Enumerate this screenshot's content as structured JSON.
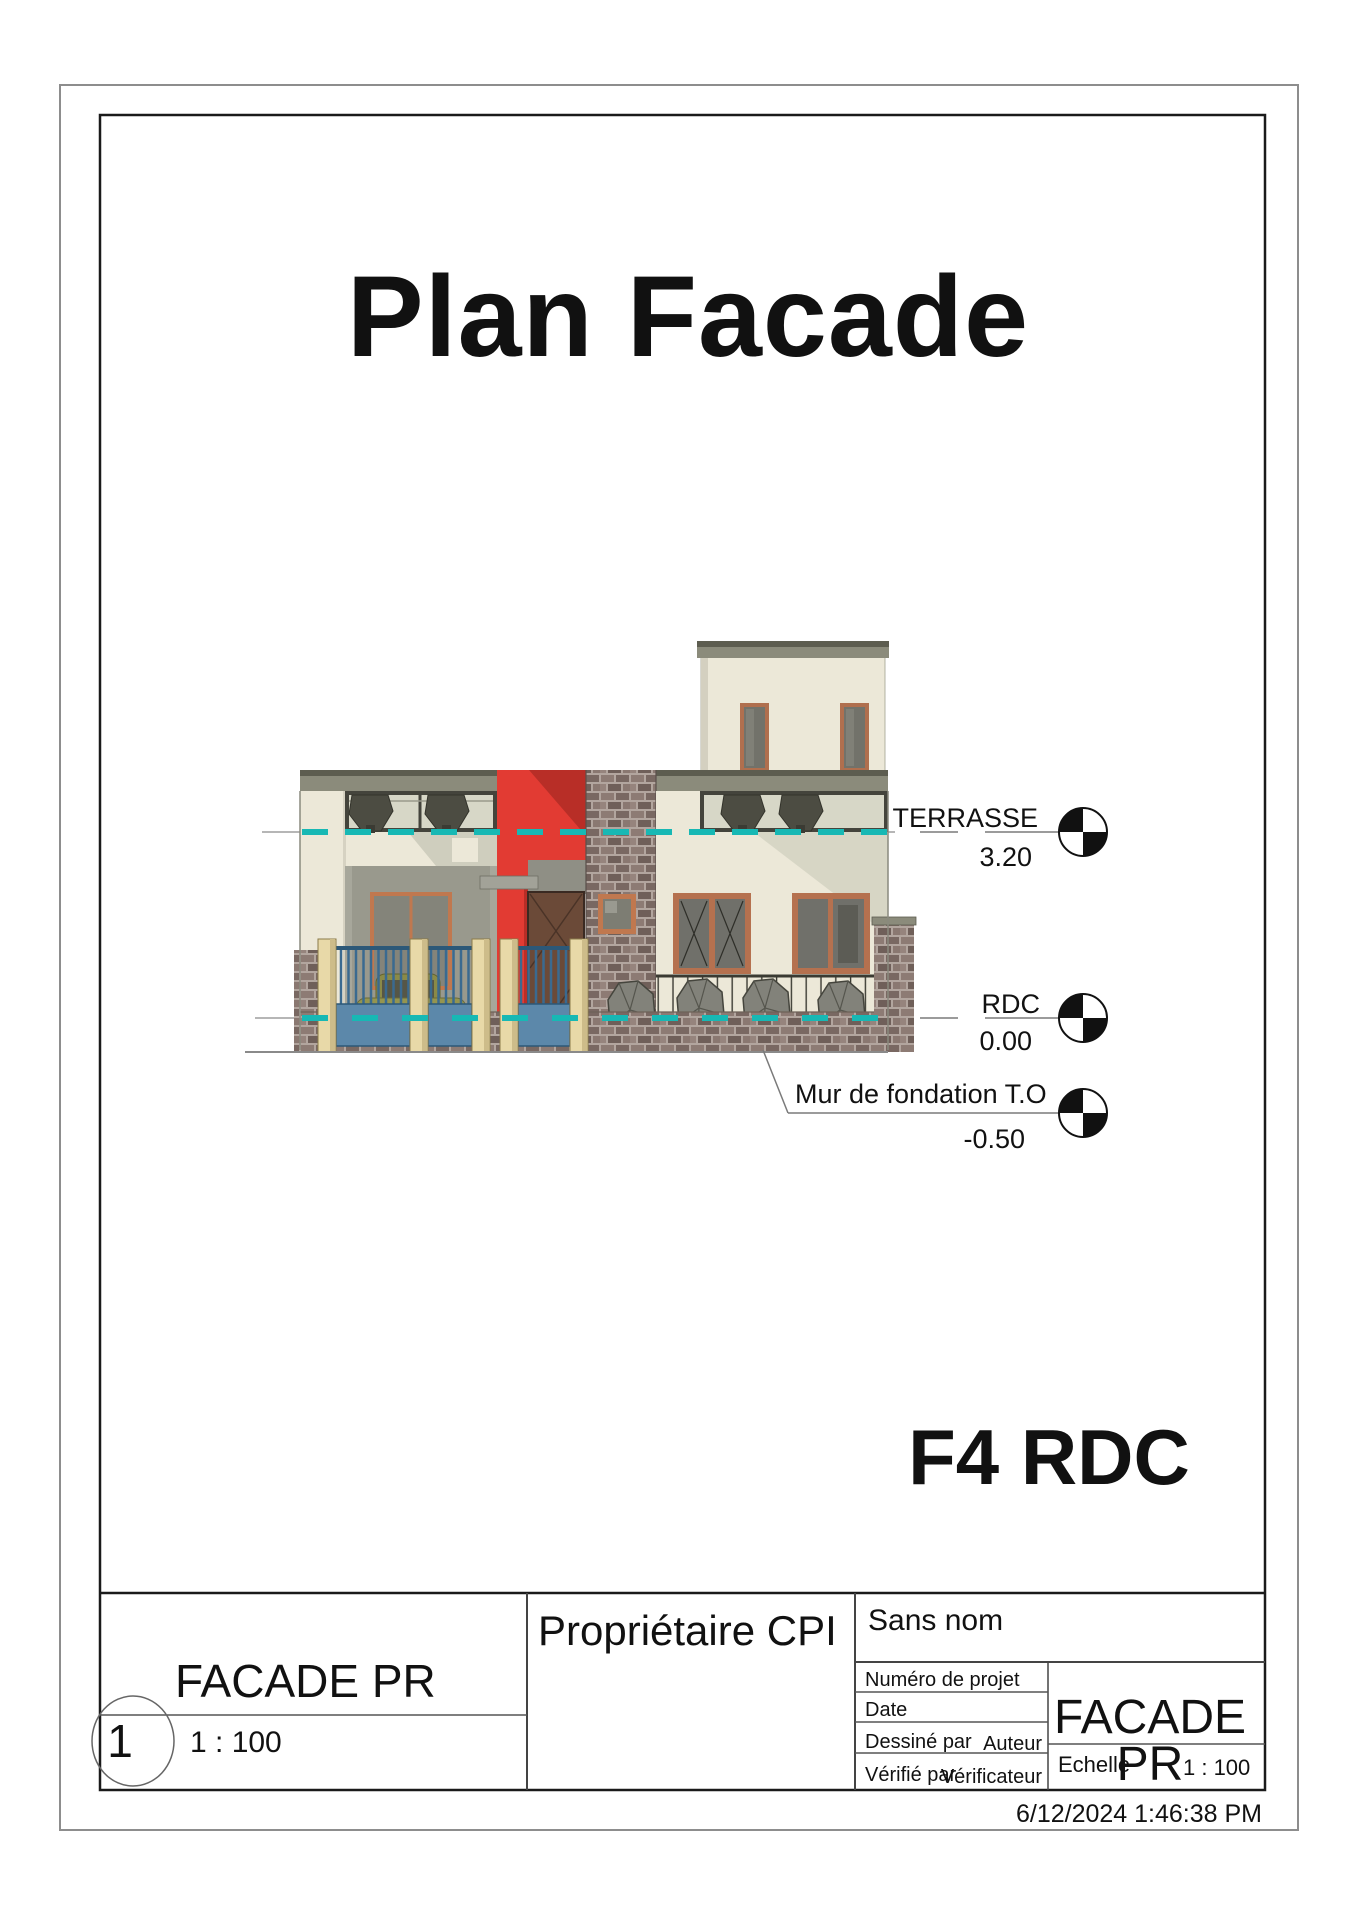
{
  "sheet": {
    "title": "Plan Facade",
    "drawing_label": "F4 RDC",
    "timestamp": "6/12/2024 1:46:38 PM"
  },
  "levels": [
    {
      "name": "TERRASSE",
      "elevation": "3.20",
      "icon": "level-datum-quadrant-circle"
    },
    {
      "name": "RDC",
      "elevation": "0.00",
      "icon": "level-datum-quadrant-circle"
    },
    {
      "name": "Mur de fondation T.O",
      "elevation": "-0.50",
      "icon": "level-datum-quadrant-circle"
    }
  ],
  "viewport": {
    "number": "1",
    "title": "FACADE PR",
    "scale": "1 : 100"
  },
  "title_block": {
    "owner": "Propriétaire CPI",
    "project_name": "Sans nom",
    "fields": [
      {
        "label": "Numéro de projet",
        "value": ""
      },
      {
        "label": "Date",
        "value": ""
      },
      {
        "label": "Dessiné par",
        "value": "Auteur"
      },
      {
        "label": "Vérifié par",
        "value": "Vérificateur"
      }
    ],
    "sheet_name_lines": [
      "FACADE",
      "PR"
    ],
    "scale_label": "Echelle",
    "scale_value": "1 : 100"
  },
  "colors": {
    "accent_red": "#e23b33",
    "level_line_teal": "#17b8b4",
    "fence_blue": "#5c88aa",
    "wall_cream": "#ece8d8",
    "roof_olive": "#8b8b7b",
    "frame_orange": "#b5714f",
    "door_brown": "#6b4a38"
  }
}
